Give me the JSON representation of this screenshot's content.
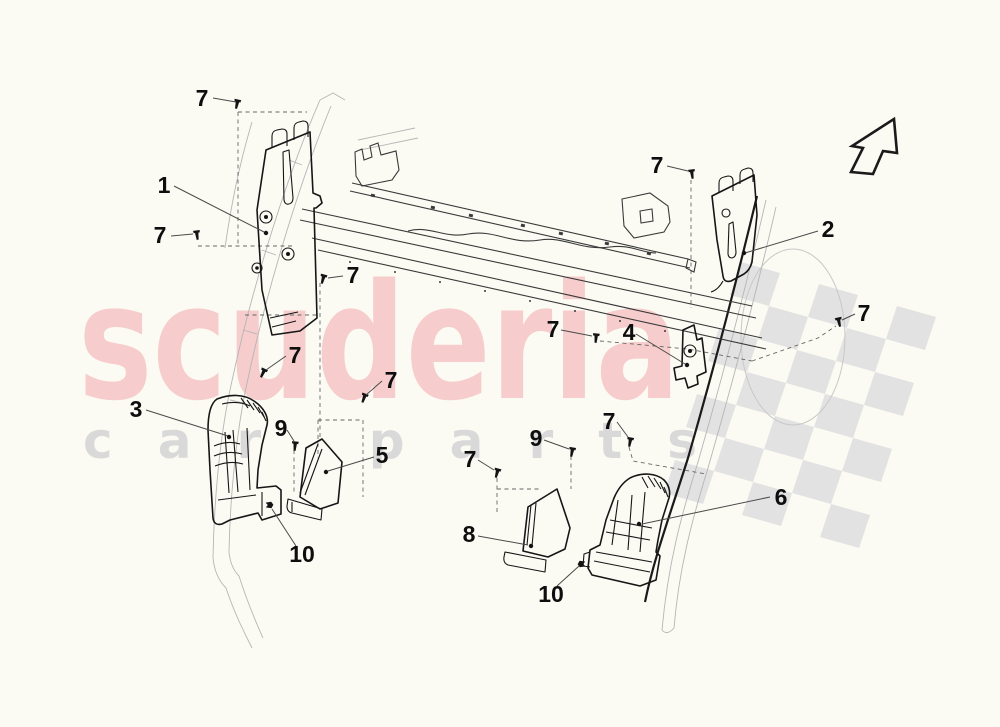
{
  "page": {
    "background": "#fbfbf4"
  },
  "watermark": {
    "brand": "scuderia",
    "tagline": "car parts",
    "brand_color": "#f7cccc",
    "tagline_color": "#d9d9d9",
    "flag_color": "#e2e2e2"
  },
  "icons": [
    {
      "name": "up-right-arrow-icon"
    },
    {
      "name": "checkered-flag-watermark"
    },
    {
      "name": "screw-fastener-icon"
    },
    {
      "name": "clip-fastener-icon"
    }
  ],
  "diagram": {
    "type": "exploded-parts-diagram",
    "callouts": [
      {
        "id": "7a",
        "label": "7"
      },
      {
        "id": "1",
        "label": "1"
      },
      {
        "id": "7b",
        "label": "7"
      },
      {
        "id": "7c",
        "label": "7"
      },
      {
        "id": "7d",
        "label": "7"
      },
      {
        "id": "7e",
        "label": "7"
      },
      {
        "id": "3",
        "label": "3"
      },
      {
        "id": "9a",
        "label": "9"
      },
      {
        "id": "5",
        "label": "5"
      },
      {
        "id": "10a",
        "label": "10"
      },
      {
        "id": "8",
        "label": "8"
      },
      {
        "id": "7f",
        "label": "7"
      },
      {
        "id": "9b",
        "label": "9"
      },
      {
        "id": "7g",
        "label": "7"
      },
      {
        "id": "10b",
        "label": "10"
      },
      {
        "id": "6",
        "label": "6"
      },
      {
        "id": "7h",
        "label": "7"
      },
      {
        "id": "4",
        "label": "4"
      },
      {
        "id": "7i",
        "label": "7"
      },
      {
        "id": "2",
        "label": "2"
      },
      {
        "id": "7j",
        "label": "7"
      }
    ]
  }
}
